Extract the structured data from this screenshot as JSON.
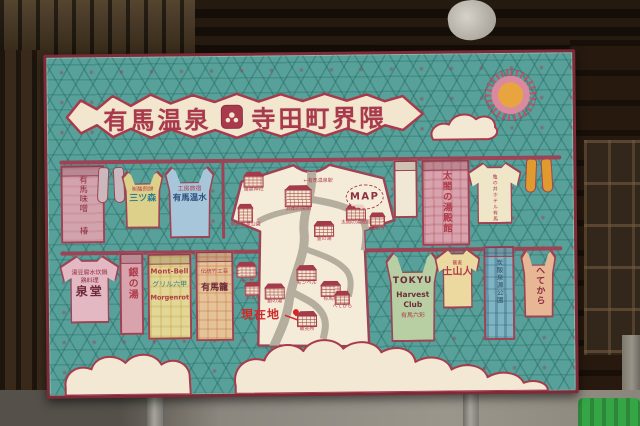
{
  "colors": {
    "board_teal": "#57a19a",
    "frame_red": "#7e2a38",
    "banner_cream": "#f2e6cf",
    "title_red": "#a93a4c",
    "clothesline": "#9c4456"
  },
  "sign": {
    "title_left": "有馬温泉",
    "title_right": "寺田町界隈"
  },
  "garments": {
    "miso_towel": {
      "line1": "有馬味噌",
      "line2": "椿"
    },
    "mitsumori_tank": {
      "line1": "炭酸煎餅",
      "line2": "三ツ森"
    },
    "kobo_tank": {
      "line1": "工房旅宿",
      "line2": "有馬温水"
    },
    "taiko_towel": {
      "line1": "太閤の湯殿館"
    },
    "kamenoi_tee": {
      "line1": "亀の井ホテル有馬"
    },
    "sendo_tee": {
      "line1": "湯豆腐水炊鍋",
      "line2": "鶏料理",
      "line3": "泉堂"
    },
    "ginnoyu_towel": {
      "line1": "銀の湯"
    },
    "montbell_towel": {
      "line1": "Mont-Bell",
      "line2": "グリル六甲",
      "line3": "Morgenrot"
    },
    "arimakago_towel": {
      "line1": "伝統竹工芸",
      "line2": "有馬籠"
    },
    "tokyu_tank": {
      "line1": "TOKYU",
      "line2": "Harvest Club",
      "line3": "有馬六彩"
    },
    "doyamajin_tee": {
      "line1": "蕎麦",
      "line2": "土山人"
    },
    "tansan_towel": {
      "line1": "炭酸泉源公園"
    },
    "hetekara_tank": {
      "line1": "へてから"
    }
  },
  "map": {
    "badge": "MAP",
    "current_location": "現在地",
    "direction_note": "←有馬温泉駅",
    "buildings": {
      "tosen_shrine": "湯泉神社",
      "gosho_park": "御所泉源公園",
      "hyoe": "兵衛向陽閣",
      "kinnoyu": "金の湯",
      "taiko_yudonokan": "太閤の湯殿館",
      "onsenji": "温泉寺",
      "mitsumori": "三ツ森",
      "montbell": "モンベル",
      "ginnoyu": "銀の湯",
      "arimakago": "有馬籠",
      "doyamajin": "土山人",
      "hetekara": "へてから",
      "uriba": "販売所"
    }
  }
}
